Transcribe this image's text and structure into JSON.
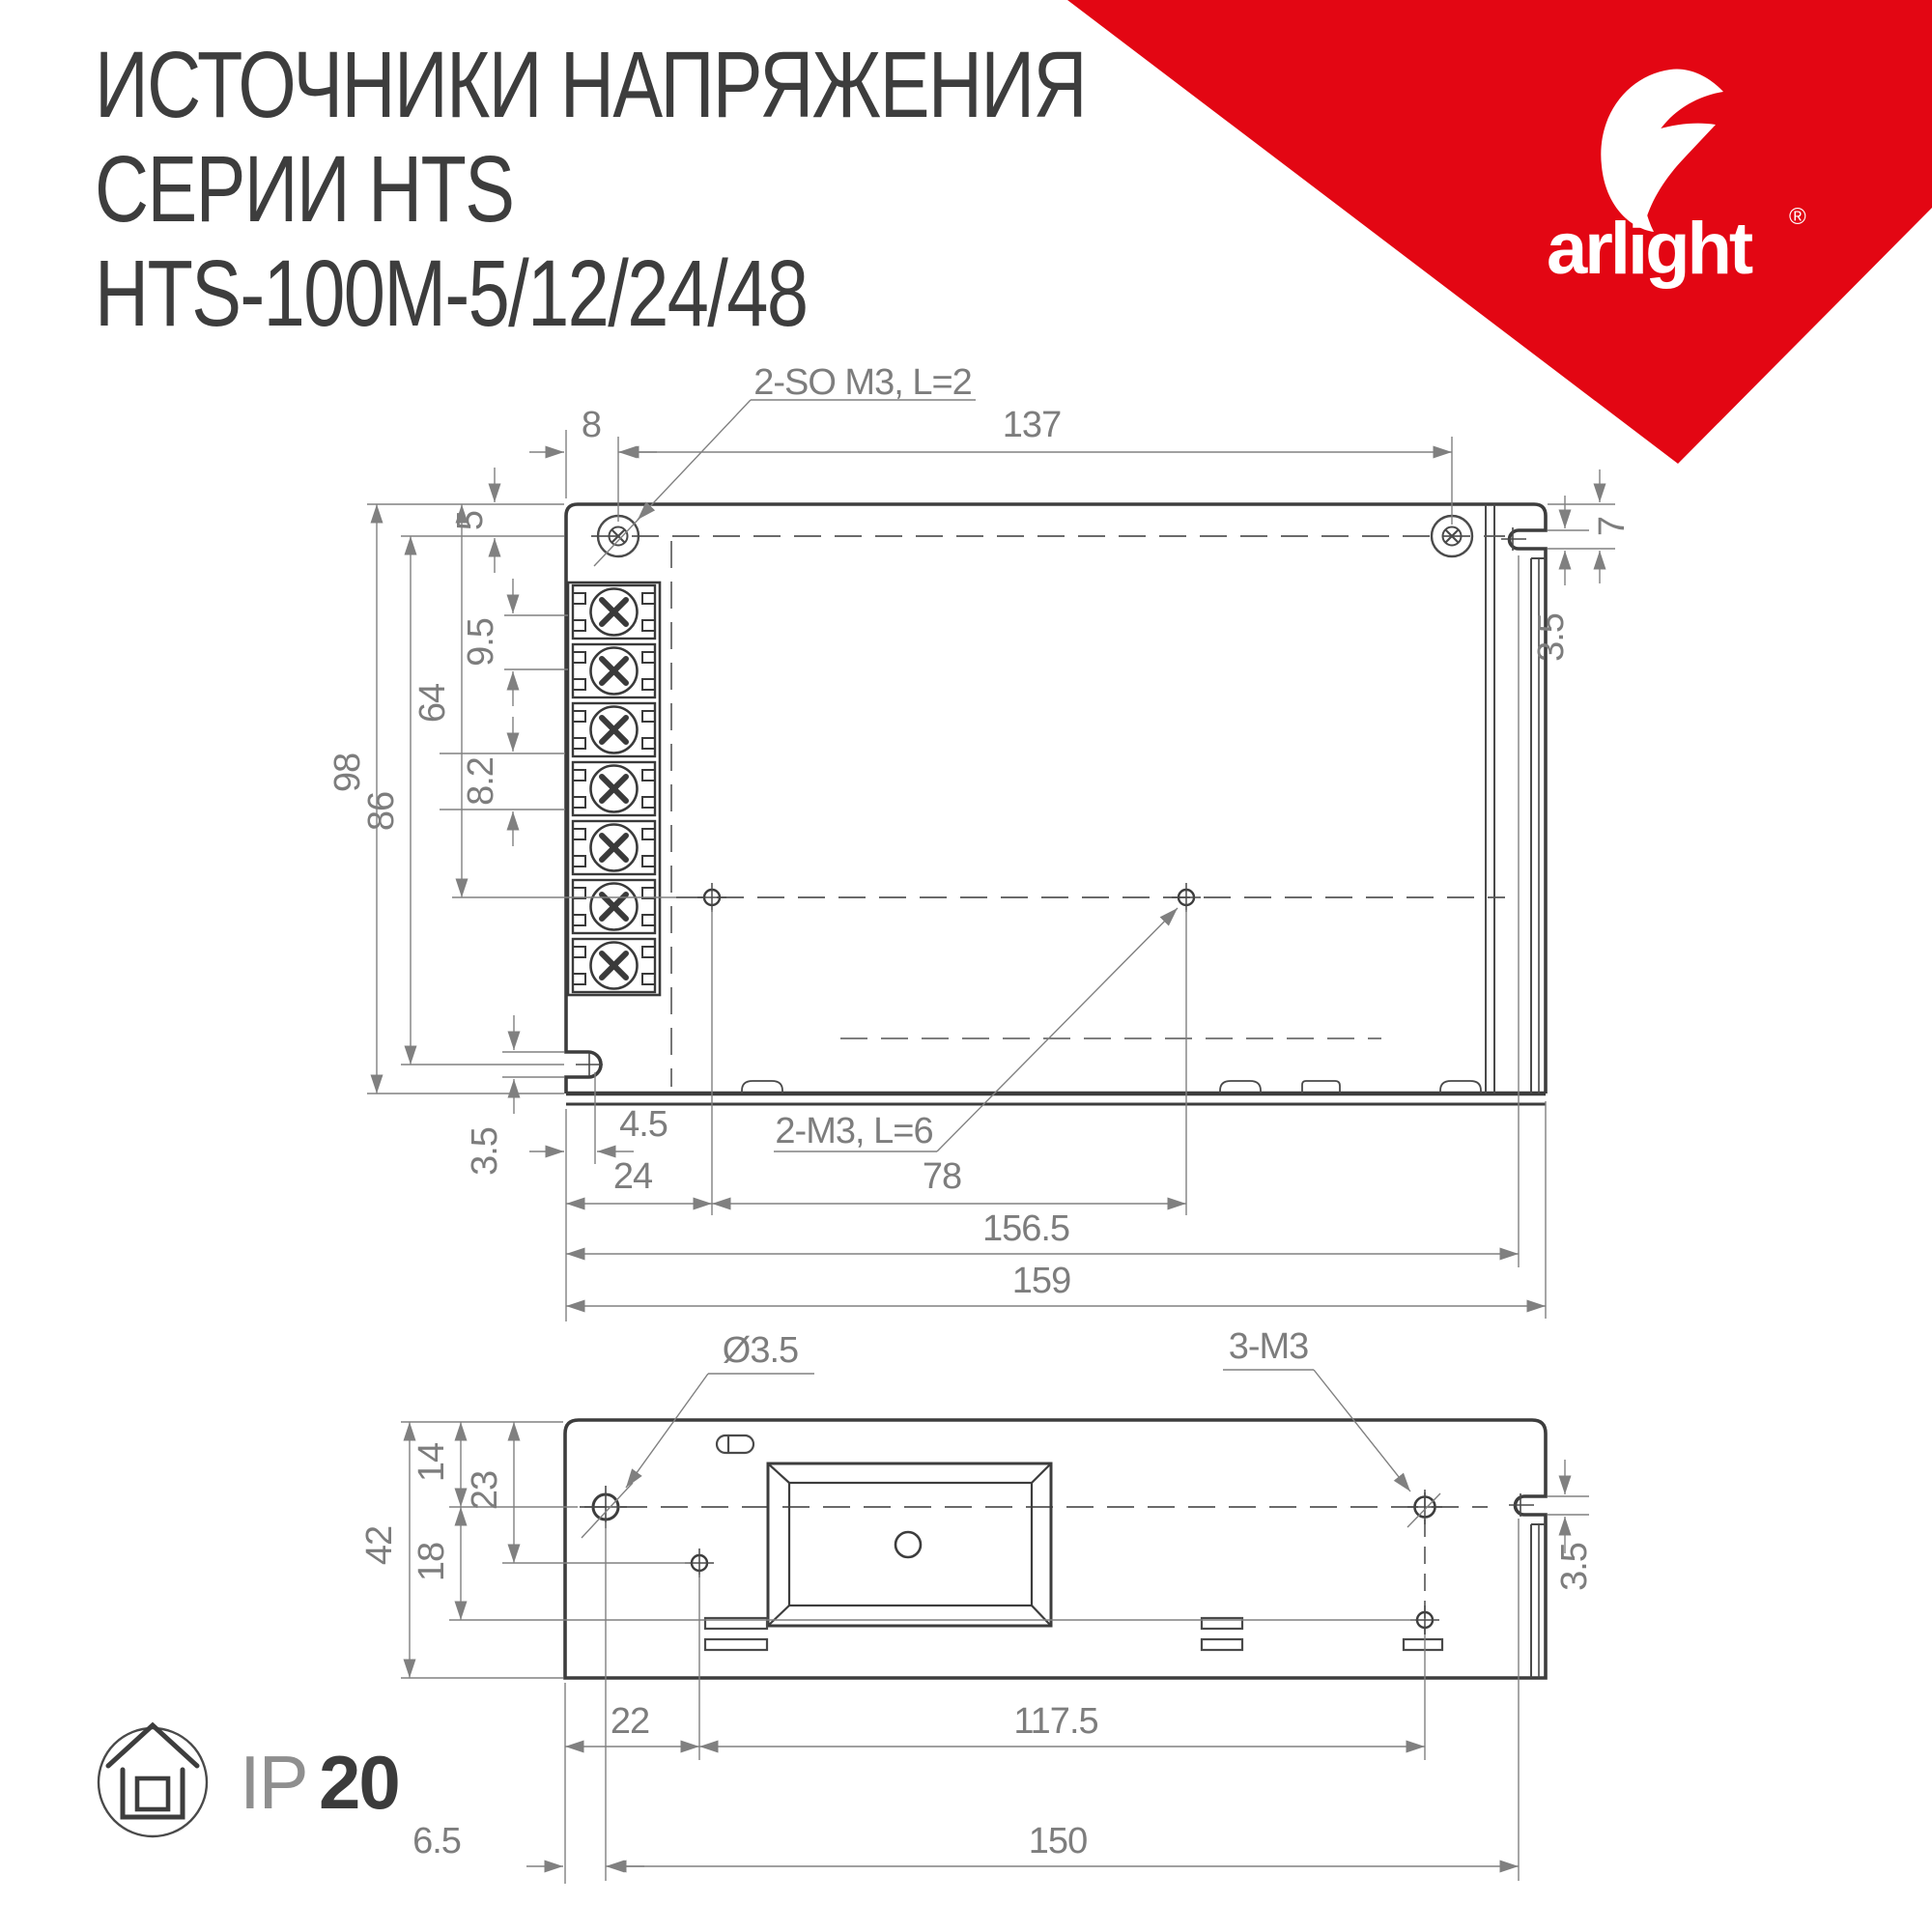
{
  "header": {
    "title_line1": "ИСТОЧНИКИ НАПРЯЖЕНИЯ",
    "title_line2": "СЕРИИ HTS",
    "title_line3": "HTS-100M-5/12/24/48"
  },
  "logo": {
    "brand": "arlight",
    "registered": "®"
  },
  "colors": {
    "brand_red": "#e30613",
    "outline_gray": "#3d3d3d",
    "line_gray": "#4f4f4f",
    "dim_gray": "#808080",
    "text_gray": "#7d7d7d",
    "title_gray": "#3d3d3d"
  },
  "top_view": {
    "callouts": {
      "screws": "2-SO M3, L=2",
      "holes": "2-M3, L=6"
    },
    "dims": {
      "w8": "8",
      "w137": "137",
      "h5": "5",
      "h9_5": "9.5",
      "h64": "64",
      "h8_2": "8.2",
      "h98": "98",
      "h86": "86",
      "h3_5": "3.5",
      "w4_5": "4.5",
      "w24": "24",
      "w78": "78",
      "w156_5": "156.5",
      "w159": "159",
      "r7": "7",
      "r3_5": "3.5"
    }
  },
  "bottom_view": {
    "callouts": {
      "hole": "Ø3.5",
      "m3": "3-M3"
    },
    "dims": {
      "h14": "14",
      "h23": "23",
      "h42": "42",
      "h18": "18",
      "w22": "22",
      "w117_5": "117.5",
      "w6_5": "6.5",
      "w150": "150",
      "r3_5": "3.5"
    }
  },
  "footer": {
    "ip_prefix": "IP",
    "ip_value": "20"
  }
}
